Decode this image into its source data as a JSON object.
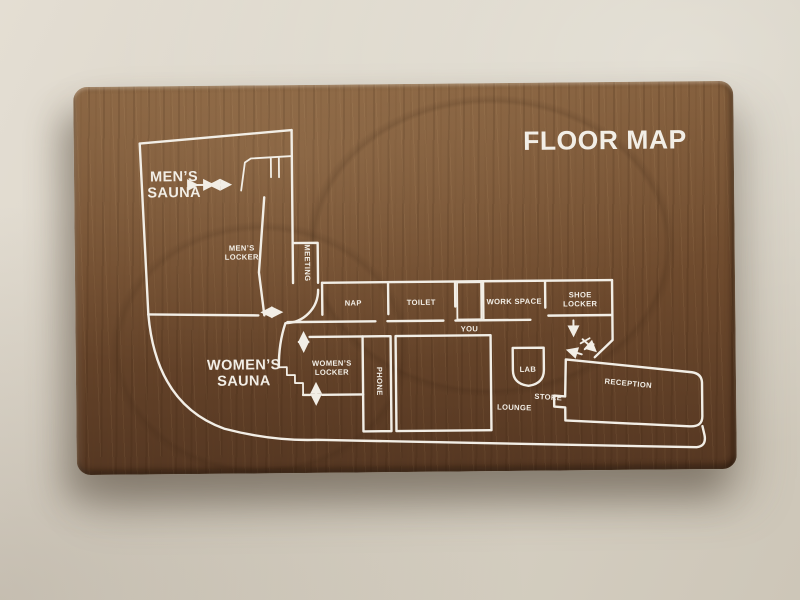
{
  "sign": {
    "title": "FLOOR MAP",
    "rooms": {
      "mens_sauna": {
        "line1": "MEN’S",
        "line2": "SAUNA"
      },
      "mens_locker": {
        "line1": "MEN’S",
        "line2": "LOCKER"
      },
      "meeting": {
        "label": "MEETING"
      },
      "nap": {
        "label": "NAP"
      },
      "toilet": {
        "label": "TOILET"
      },
      "you": {
        "label": "YOU"
      },
      "work_space": {
        "label": "WORK SPACE"
      },
      "shoe_locker": {
        "line1": "SHOE",
        "line2": "LOCKER"
      },
      "womens_sauna": {
        "line1": "WOMEN’S",
        "line2": "SAUNA"
      },
      "womens_locker": {
        "line1": "WOMEN’S",
        "line2": "LOCKER"
      },
      "phone": {
        "label": "PHONE"
      },
      "lab": {
        "label": "LAB"
      },
      "lounge": {
        "label": "LOUNGE"
      },
      "store": {
        "label": "STORE"
      },
      "reception": {
        "label": "RECEPTION"
      }
    },
    "colors": {
      "wall": "#d9d3c6",
      "wood_base": "#6f4b2e",
      "wood_light": "#85603e",
      "wood_dark": "#553722",
      "line": "#f2eee6"
    }
  }
}
